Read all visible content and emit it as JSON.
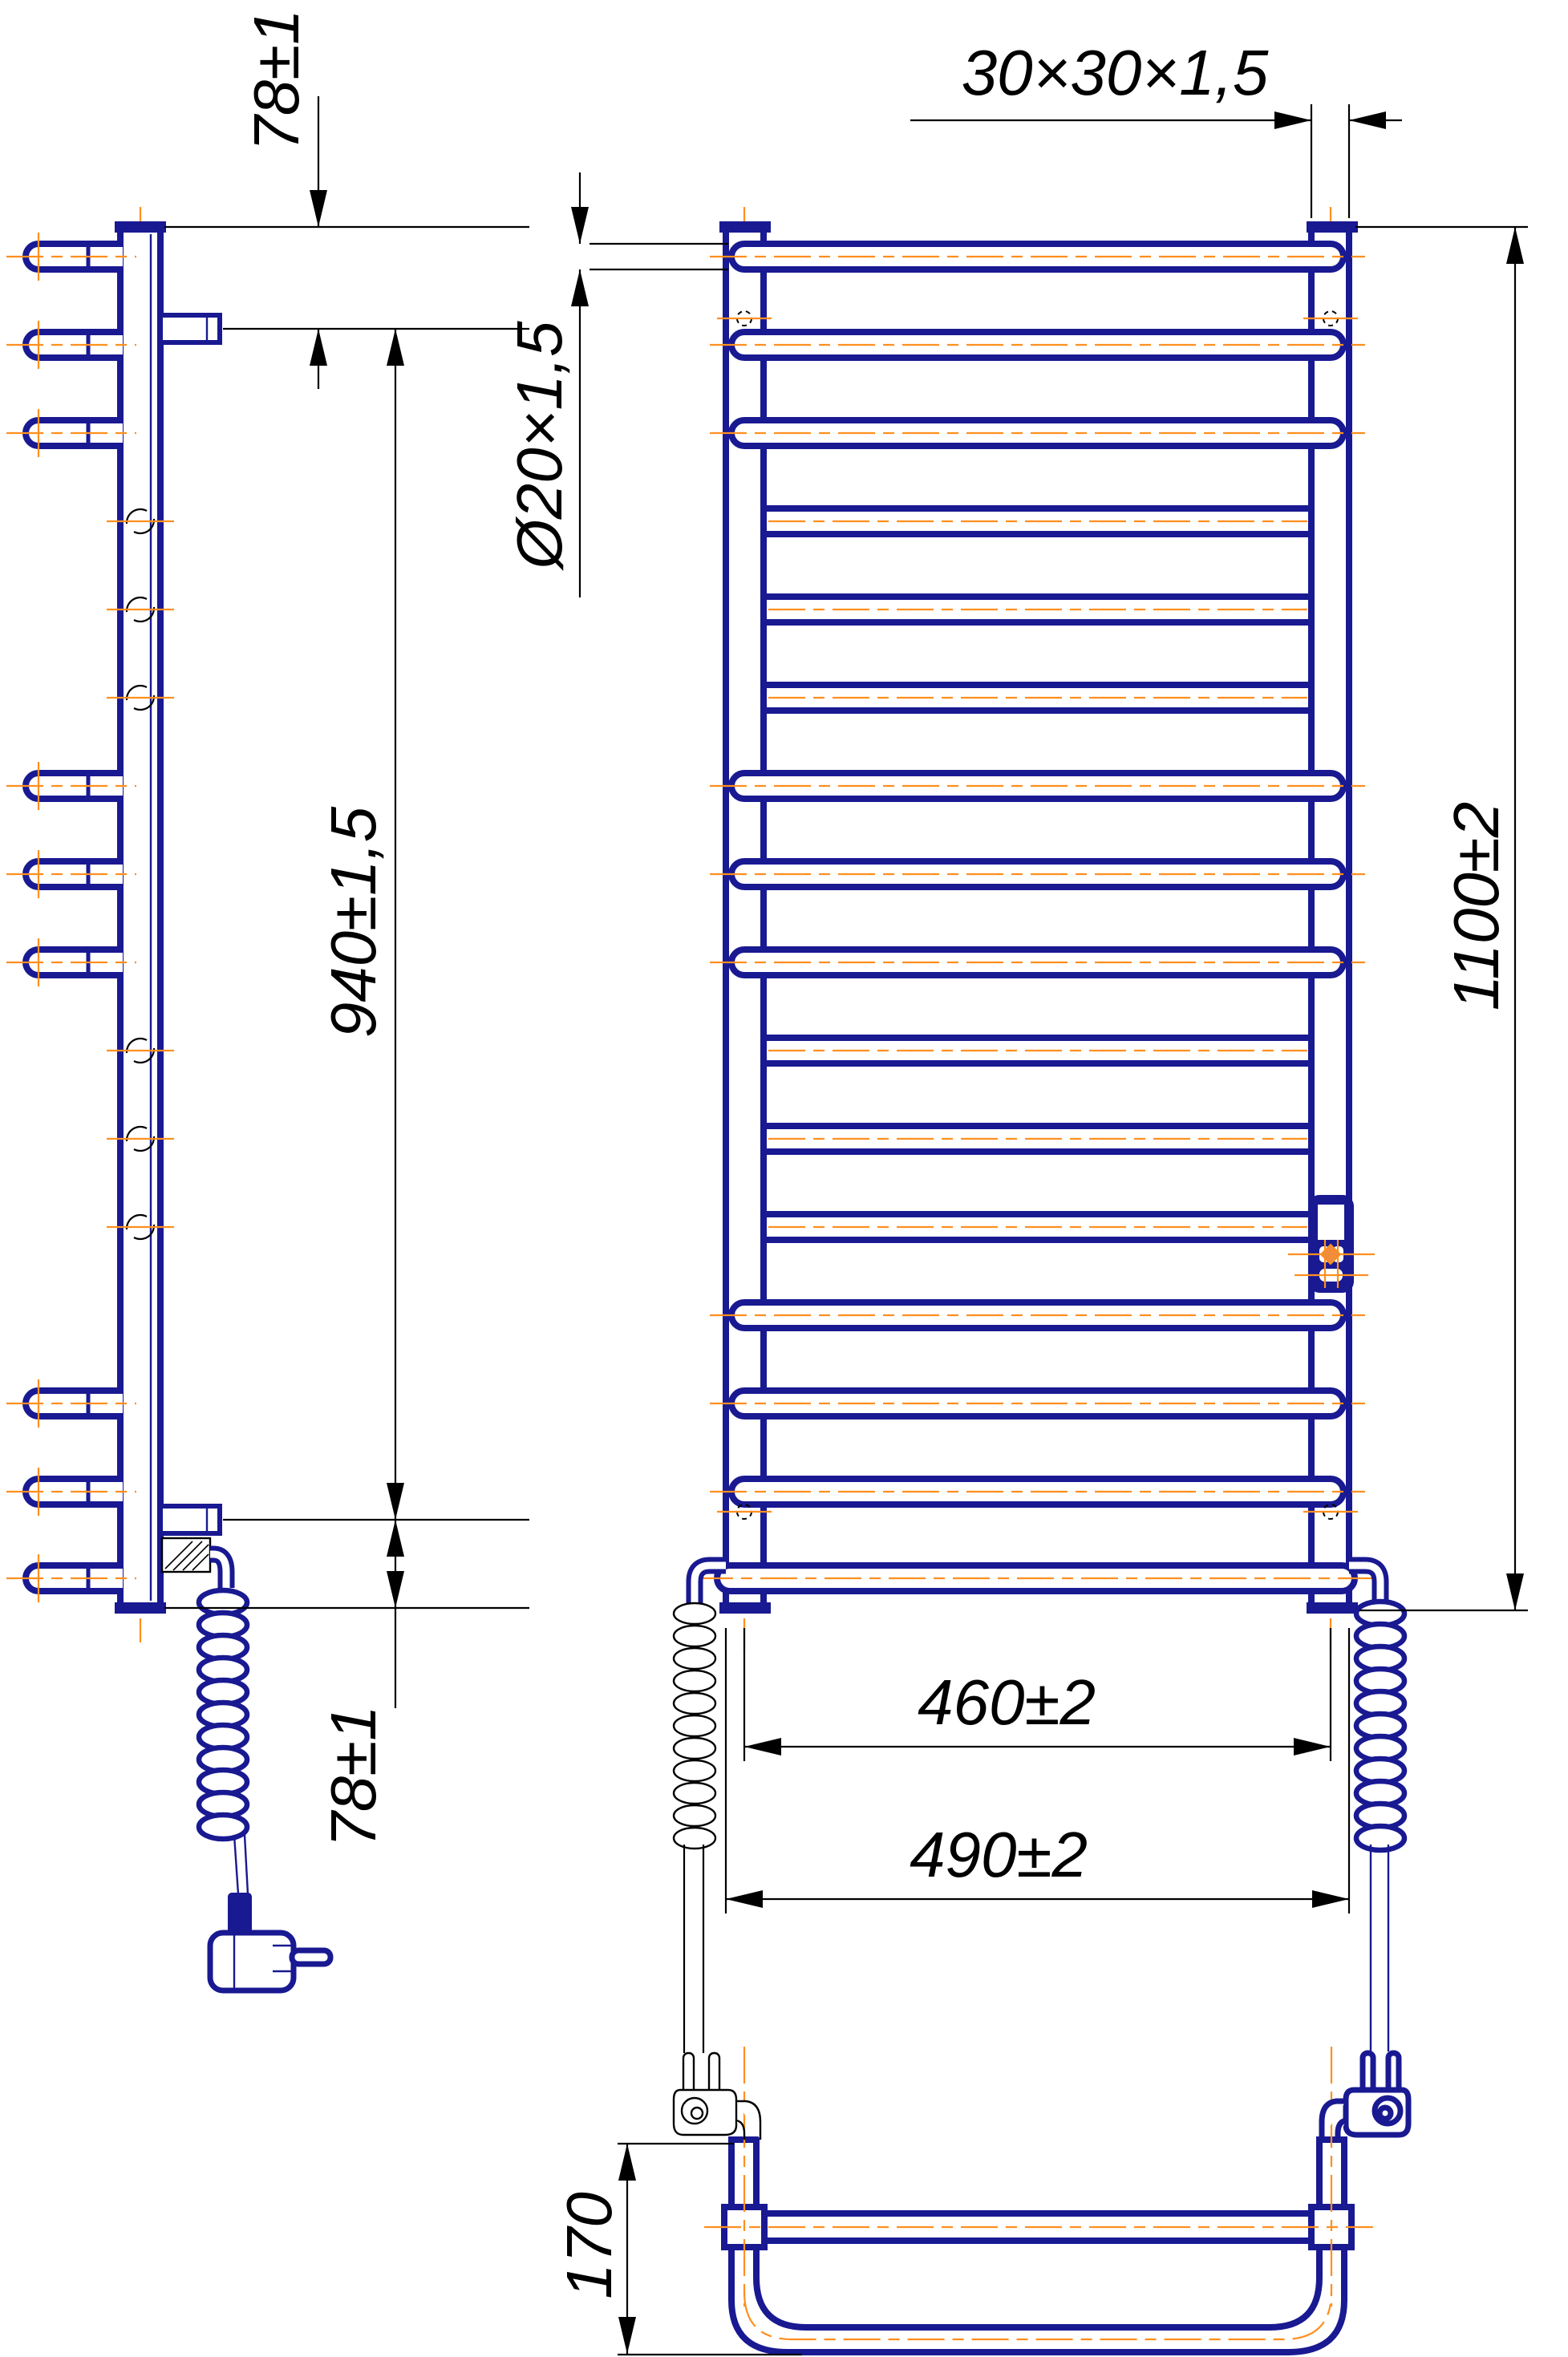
{
  "drawing": {
    "dimensions": {
      "top_offset": "78±1",
      "post_profile": "30×30×1,5",
      "rung_diameter": "Ø20×1,5",
      "bracket_span": "940±1,5",
      "overall_height": "1100±2",
      "rung_span": "460±2",
      "overall_width": "490±2",
      "bottom_offset": "78±1",
      "depth": "170"
    },
    "colors": {
      "outline": "#191992",
      "centerline": "#FF8F1F",
      "dimension_lines": "#000000",
      "background": "#FFFFFF"
    }
  }
}
